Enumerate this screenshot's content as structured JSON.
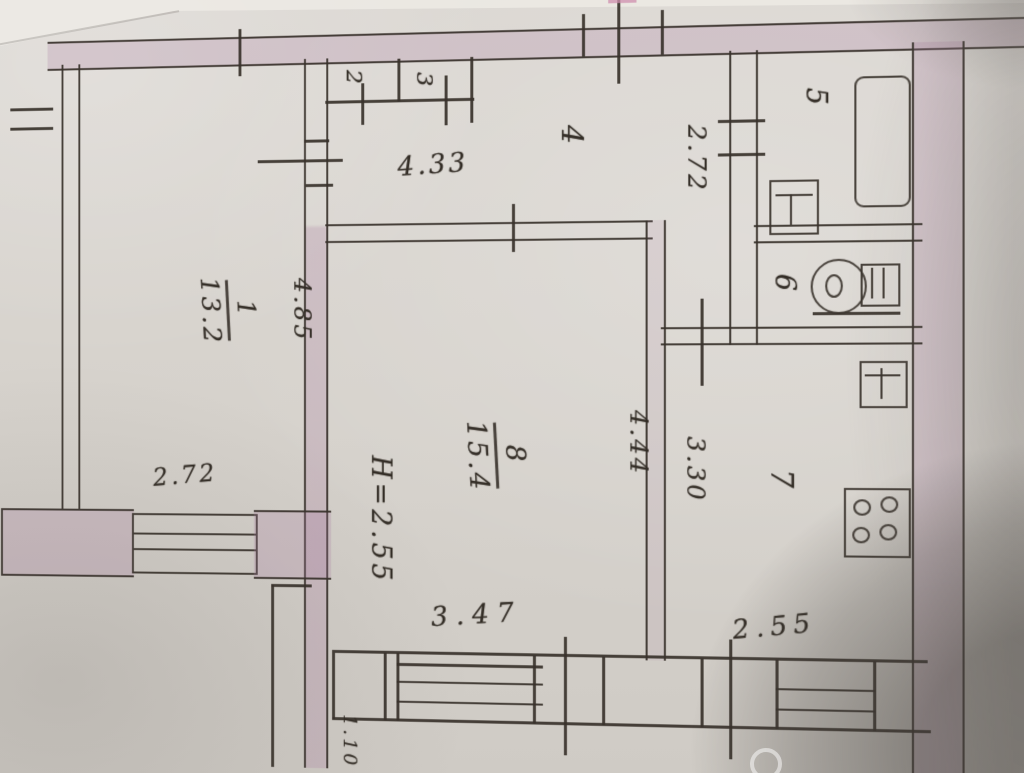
{
  "document": {
    "kind": "scanned hand-drawn apartment floor plan",
    "colors": {
      "paper": "#d7d3cd",
      "ink": "#38322b",
      "wall_fill": "#cfc0ca",
      "photo_shadow": "#8f8b87",
      "top_mark_pink": "#cf8fae"
    }
  },
  "labels": {
    "room1_number": "1",
    "room1_area": "13.2",
    "room2": "2",
    "room3": "3",
    "room4": "4",
    "room5": "5",
    "room6": "6",
    "room7": "7",
    "room8_number": "8",
    "room8_area": "15.4"
  },
  "dimensions": {
    "hall_width": "4.33",
    "bath_corridor_depth": "2.72",
    "room1_width": "2.72",
    "room1_depth": "4.85",
    "ceiling_height": "H=2.55",
    "room8_depth": "4.44",
    "room8_width": "3.47",
    "kitchen_width": "3.30",
    "kitchen_bottom_width": "2.55",
    "balcony_door_width": "1.10"
  },
  "fixtures": {
    "bathtub": "bathtub",
    "bath_sink": "washbasin",
    "toilet": "toilet-with-cistern",
    "kitchen_sink": "kitchen-sink",
    "stove": "stove-4-burner"
  }
}
